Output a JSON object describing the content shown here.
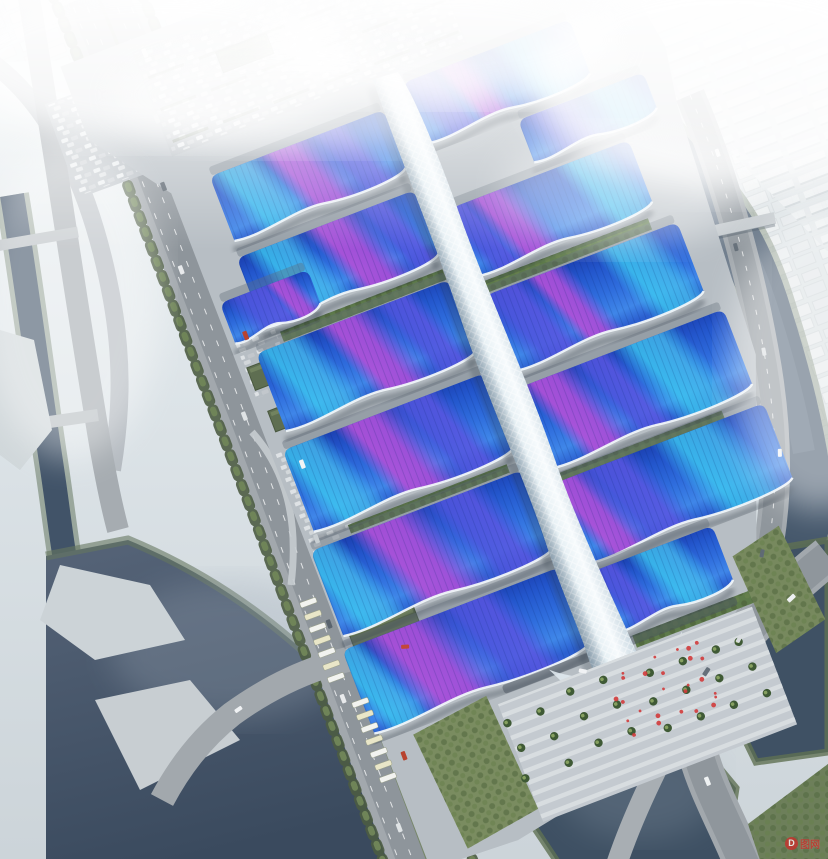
{
  "meta": {
    "type": "aerial-architectural-rendering",
    "subject": "Riverside exhibition and convention center complex with wave-form blue roofs, purple ribbon patterns and a white central pedestrian spine, surrounded by canals, boulevards and a hazy city skyline",
    "canvas": {
      "w": 828,
      "h": 859
    }
  },
  "palette": {
    "sky_haze": "#eef3f5",
    "ground": "#b7bec4",
    "road": "#9aa1a7",
    "water_dark": "#3e5063",
    "water_mist": "#8593a6",
    "roof_blue_deep": "#1b3fb0",
    "roof_blue_bright": "#3f86e8",
    "ribbon_magenta": "#a84fd6",
    "ribbon_violet": "#5055dd",
    "ribbon_cyan": "#3cc8f0",
    "spine_white": "#eff5f8",
    "tree_green": "#4c5c43",
    "lawn_green": "#7a8c60",
    "accent_red": "#d23b3b"
  },
  "complex": {
    "spine": {
      "label": "central-pedestrian-spine"
    },
    "halls": [
      {
        "id": "E1",
        "x": 14,
        "y": 0,
        "w": 178,
        "h": 70,
        "ribbons": [
          {
            "c": "violet",
            "cx": 0.16,
            "w": 0.24
          },
          {
            "c": "magenta",
            "cx": 0.38,
            "w": 0.22
          },
          {
            "c": "cyan",
            "cx": 0.78,
            "w": 0.34
          }
        ]
      },
      {
        "id": "E1b",
        "x": 108,
        "y": 76,
        "w": 134,
        "h": 50,
        "ribbons": [
          {
            "c": "violet",
            "cx": 0.32,
            "w": 0.45
          },
          {
            "c": "cyan",
            "cx": 0.78,
            "w": 0.38
          }
        ]
      },
      {
        "id": "E2",
        "x": 14,
        "y": 134,
        "w": 190,
        "h": 78,
        "ribbons": [
          {
            "c": "violet",
            "cx": 0.1,
            "w": 0.2
          },
          {
            "c": "magenta",
            "cx": 0.3,
            "w": 0.26
          },
          {
            "c": "cyan",
            "cx": 0.82,
            "w": 0.3
          }
        ]
      },
      {
        "id": "E3",
        "x": 14,
        "y": 228,
        "w": 206,
        "h": 86,
        "ribbons": [
          {
            "c": "violet",
            "cx": 0.17,
            "w": 0.28
          },
          {
            "c": "magenta",
            "cx": 0.4,
            "w": 0.2
          },
          {
            "c": "cyan",
            "cx": 0.8,
            "w": 0.3
          }
        ]
      },
      {
        "id": "E4",
        "x": 14,
        "y": 326,
        "w": 218,
        "h": 92,
        "ribbons": [
          {
            "c": "magenta",
            "cx": 0.22,
            "w": 0.26
          },
          {
            "c": "violet",
            "cx": 0.44,
            "w": 0.2
          },
          {
            "c": "cyan",
            "cx": 0.7,
            "w": 0.3
          }
        ]
      },
      {
        "id": "E5",
        "x": 14,
        "y": 428,
        "w": 222,
        "h": 92,
        "ribbons": [
          {
            "c": "magenta",
            "cx": 0.13,
            "w": 0.22
          },
          {
            "c": "violet",
            "cx": 0.32,
            "w": 0.28
          },
          {
            "c": "cyan",
            "cx": 0.72,
            "w": 0.34
          }
        ]
      },
      {
        "id": "E6",
        "x": 14,
        "y": 524,
        "w": 130,
        "h": 70,
        "ribbons": [
          {
            "c": "violet",
            "cx": 0.2,
            "w": 0.3
          },
          {
            "c": "cyan",
            "cx": 0.62,
            "w": 0.42
          }
        ]
      },
      {
        "id": "W1",
        "x": -200,
        "y": 18,
        "w": 186,
        "h": 74,
        "ribbons": [
          {
            "c": "cyan",
            "cx": 0.22,
            "w": 0.3
          },
          {
            "c": "magenta",
            "cx": 0.52,
            "w": 0.3
          },
          {
            "c": "violet",
            "cx": 0.76,
            "w": 0.24
          }
        ]
      },
      {
        "id": "W2",
        "x": -204,
        "y": 104,
        "w": 190,
        "h": 80,
        "ribbons": [
          {
            "c": "cyan",
            "cx": 0.28,
            "w": 0.3
          },
          {
            "c": "magenta",
            "cx": 0.62,
            "w": 0.3
          },
          {
            "c": "violet",
            "cx": 0.85,
            "w": 0.2
          }
        ]
      },
      {
        "id": "W2b",
        "x": -236,
        "y": 140,
        "w": 94,
        "h": 48,
        "ribbons": [
          {
            "c": "violet",
            "cx": 0.45,
            "w": 0.6
          },
          {
            "c": "magenta",
            "cx": 0.78,
            "w": 0.3
          }
        ]
      },
      {
        "id": "W3",
        "x": -220,
        "y": 200,
        "w": 206,
        "h": 88,
        "ribbons": [
          {
            "c": "cyan",
            "cx": 0.2,
            "w": 0.3
          },
          {
            "c": "magenta",
            "cx": 0.55,
            "w": 0.28
          },
          {
            "c": "violet",
            "cx": 0.8,
            "w": 0.22
          }
        ]
      },
      {
        "id": "W4",
        "x": -230,
        "y": 300,
        "w": 216,
        "h": 92,
        "ribbons": [
          {
            "c": "cyan",
            "cx": 0.15,
            "w": 0.28
          },
          {
            "c": "magenta",
            "cx": 0.5,
            "w": 0.3
          },
          {
            "c": "violet",
            "cx": 0.74,
            "w": 0.25
          }
        ]
      },
      {
        "id": "W5",
        "x": -240,
        "y": 404,
        "w": 226,
        "h": 96,
        "ribbons": [
          {
            "c": "cyan",
            "cx": 0.1,
            "w": 0.25
          },
          {
            "c": "magenta",
            "cx": 0.45,
            "w": 0.34
          },
          {
            "c": "violet",
            "cx": 0.76,
            "w": 0.28
          }
        ]
      },
      {
        "id": "W6",
        "x": -246,
        "y": 508,
        "w": 232,
        "h": 94,
        "ribbons": [
          {
            "c": "cyan",
            "cx": 0.08,
            "w": 0.2
          },
          {
            "c": "magenta",
            "cx": 0.36,
            "w": 0.36
          },
          {
            "c": "violet",
            "cx": 0.66,
            "w": 0.3
          }
        ]
      }
    ],
    "courtyards": [
      {
        "x": 14,
        "y": 214,
        "w": 180,
        "h": 12
      },
      {
        "x": -190,
        "y": 188,
        "w": 174,
        "h": 11
      },
      {
        "x": 14,
        "y": 420,
        "w": 180,
        "h": 9
      },
      {
        "x": -196,
        "y": 393,
        "w": 170,
        "h": 9
      },
      {
        "x": 30,
        "y": 598,
        "w": 150,
        "h": 13
      }
    ],
    "sheds": [
      {
        "x": -234,
        "y": 210,
        "w": 56,
        "h": 24
      },
      {
        "x": -230,
        "y": 258,
        "w": 50,
        "h": 22
      },
      {
        "x": -238,
        "y": 420,
        "w": 60,
        "h": 26
      },
      {
        "x": -234,
        "y": 492,
        "w": 70,
        "h": 28
      },
      {
        "x": -150,
        "y": -96,
        "w": 54,
        "h": 22
      }
    ],
    "plaza": {
      "x": -120,
      "y": 614,
      "w": 272,
      "h": 126
    },
    "palm_rows": [
      640,
      668,
      698
    ],
    "crowd": {
      "count": 26,
      "color": "#d23b3b"
    }
  },
  "environment": {
    "river_bridges": 2,
    "canal_bridges": 2,
    "bus_bays": 2,
    "tower_clusters": 3
  },
  "watermark": {
    "logo_letter": "D",
    "text": "图网",
    "color": "#c9302c"
  }
}
